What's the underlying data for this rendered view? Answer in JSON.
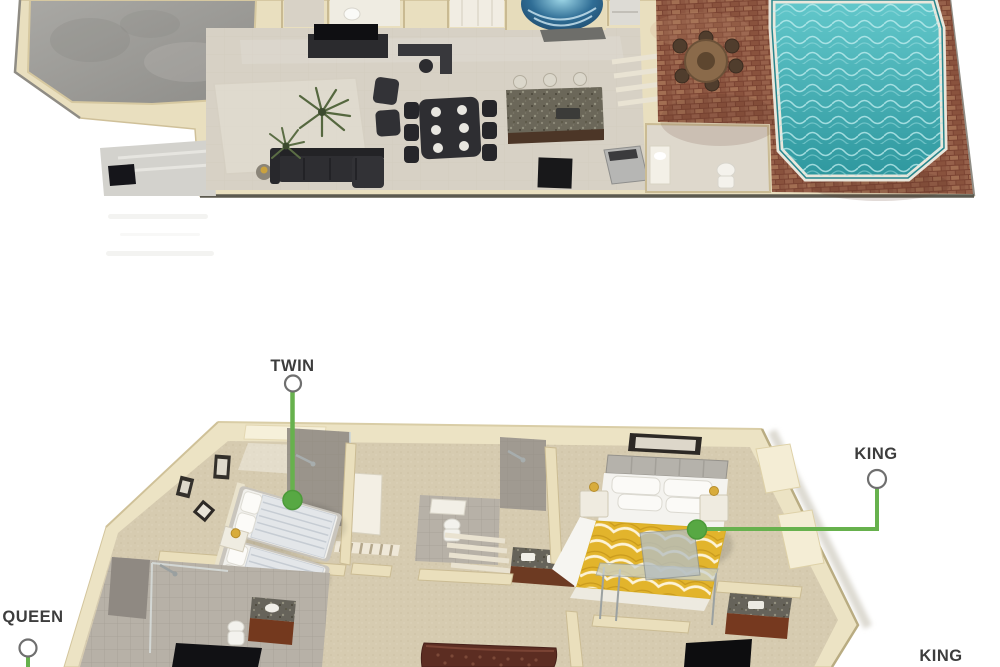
{
  "page": {
    "background_color": "#ffffff",
    "description": "two-level 3D villa floorplan rendering with bed size callouts"
  },
  "callouts": [
    {
      "name": "twin-callout",
      "label": "TWIN"
    },
    {
      "name": "king-master-callout",
      "label": "KING"
    },
    {
      "name": "queen-callout",
      "label": "QUEEN"
    },
    {
      "name": "king-second-callout",
      "label": "KING"
    }
  ],
  "colors": {
    "callout_line_green": "#67b14d",
    "callout_dot_green": "#57a843",
    "callout_circle_stroke": "#6f6f6f",
    "label_text": "#3d3d3d",
    "wall_cream": "#ece3c4",
    "floor_tile": "#d7d1c5",
    "carpet_tan": "#d6cbb0",
    "garage_concrete": "#9b9a96",
    "pool_water_teal": "#3fa9ad",
    "spa_cover_blue": "#2f6d95",
    "patio_brick": "#8a5743",
    "bed_duvet_gold": "#e2b42c",
    "dark_furniture": "#2e2e32",
    "wood_vanity": "#76391f"
  },
  "floorplans": [
    {
      "name": "main-level-floorplan",
      "rooms": [
        "garage",
        "living-room",
        "dining-area",
        "kitchen",
        "spa-nook",
        "pool-bathroom",
        "brick-patio",
        "swimming-pool"
      ]
    },
    {
      "name": "bedroom-level-floorplan",
      "rooms": [
        "twin-bedroom",
        "twin-bathroom",
        "hallway",
        "middle-bathroom",
        "king-bedroom",
        "king-ensuite",
        "queen-bedroom-partial"
      ]
    }
  ]
}
